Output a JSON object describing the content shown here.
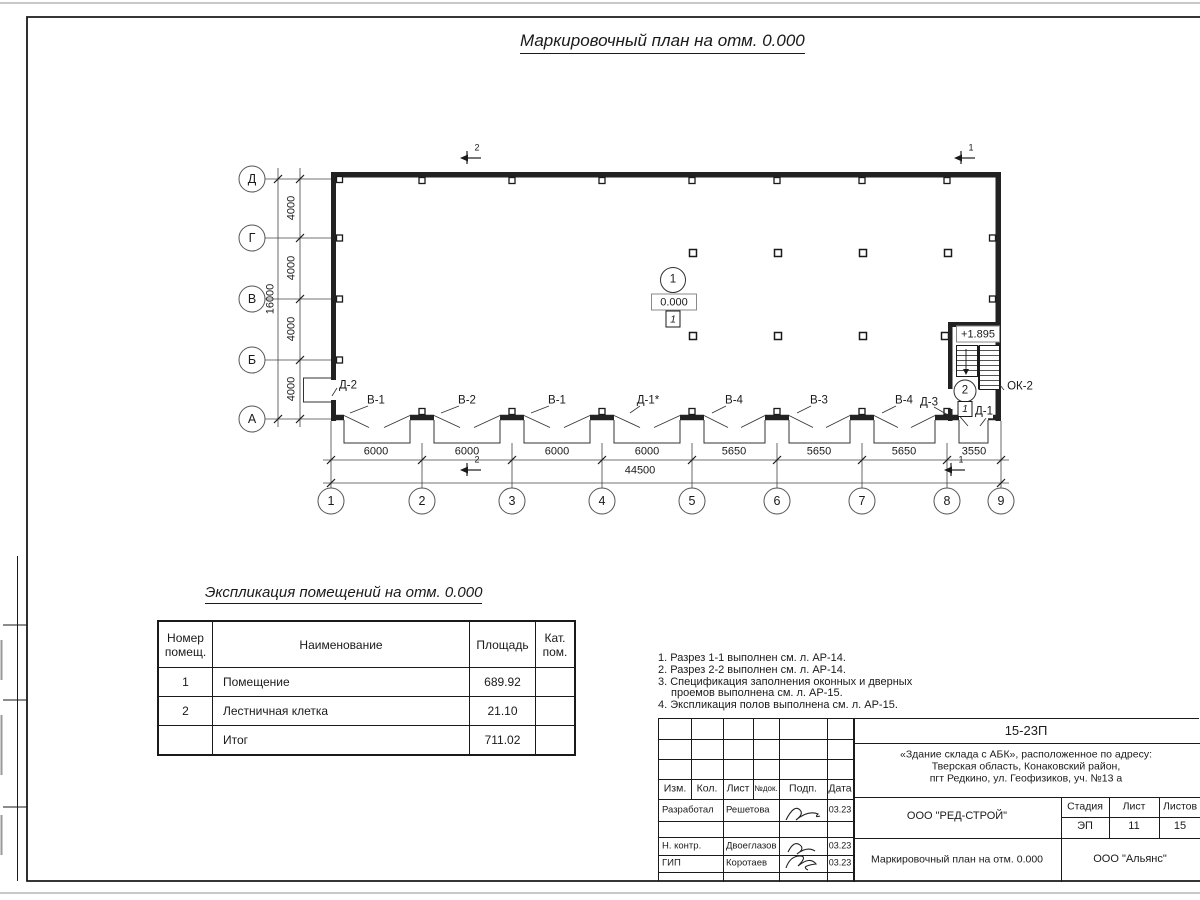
{
  "page": {
    "drawing_title": "Маркировочный план на отм. 0.000",
    "table_title": "Экспликация помещений на отм. 0.000"
  },
  "plan": {
    "row_axes": [
      "Д",
      "Г",
      "В",
      "Б",
      "А"
    ],
    "col_axes": [
      "1",
      "2",
      "3",
      "4",
      "5",
      "6",
      "7",
      "8",
      "9"
    ],
    "row_dims": [
      "4000",
      "4000",
      "4000",
      "4000"
    ],
    "row_total": "16000",
    "col_dims": [
      "6000",
      "6000",
      "6000",
      "6000",
      "5650",
      "5650",
      "5650",
      "3550"
    ],
    "col_total": "44500",
    "opening_labels": [
      "В-1",
      "В-2",
      "В-1",
      "Д-1*",
      "В-4",
      "В-3",
      "В-4"
    ],
    "d2": "Д-2",
    "d3": "Д-3",
    "d1": "Д-1",
    "ok2": "ОК-2",
    "room1": {
      "number": "1",
      "level": "0.000",
      "floor_mark": "1"
    },
    "room2": {
      "number": "2",
      "level": "+1.895",
      "floor_mark": "1"
    },
    "section_marks": {
      "s1": "1",
      "s2": "2"
    }
  },
  "table": {
    "headers": {
      "num": "Номер помещ.",
      "name": "Наименование",
      "area": "Площадь",
      "cat": "Кат. пом."
    },
    "rows": [
      {
        "num": "1",
        "name": "Помещение",
        "area": "689.92",
        "cat": ""
      },
      {
        "num": "2",
        "name": "Лестничная клетка",
        "area": "21.10",
        "cat": ""
      },
      {
        "num": "",
        "name": "Итог",
        "area": "711.02",
        "cat": ""
      }
    ]
  },
  "notes": {
    "lines": [
      "1. Разрез 1-1 выполнен см. л. АР-14.",
      "2. Разрез 2-2 выполнен см. л. АР-14.",
      "3. Спецификация заполнения оконных и дверных",
      "проемов выполнена см. л. АР-15.",
      "4. Экспликация полов выполнена см. л. АР-15."
    ]
  },
  "titleblock": {
    "doc_number": "15-23П",
    "project_line1": "«Здание склада с АБК», расположенное по адресу:",
    "project_line2": "Тверская область, Конаковский район,",
    "project_line3": "пгт Редкино, ул. Геофизиков, уч. №13 а",
    "cols": {
      "izm": "Изм.",
      "kol": "Кол.",
      "list": "Лист",
      "ndok": "№док.",
      "podp": "Подп.",
      "data": "Дата"
    },
    "rows": [
      {
        "role": "Разработал",
        "name": "Решетова",
        "date": "03.23"
      },
      {
        "role": "Н. контр.",
        "name": "Двоеглазов",
        "date": "03.23"
      },
      {
        "role": "ГИП",
        "name": "Коротаев",
        "date": "03.23"
      }
    ],
    "company": "ООО \"РЕД-СТРОЙ\"",
    "sheet_title": "Маркировочный план на отм. 0.000",
    "stage_label": "Стадия",
    "sheet_label": "Лист",
    "sheets_label": "Листов",
    "stage": "ЭП",
    "sheet": "11",
    "sheets": "15",
    "contractor": "ООО \"Альянс\""
  }
}
